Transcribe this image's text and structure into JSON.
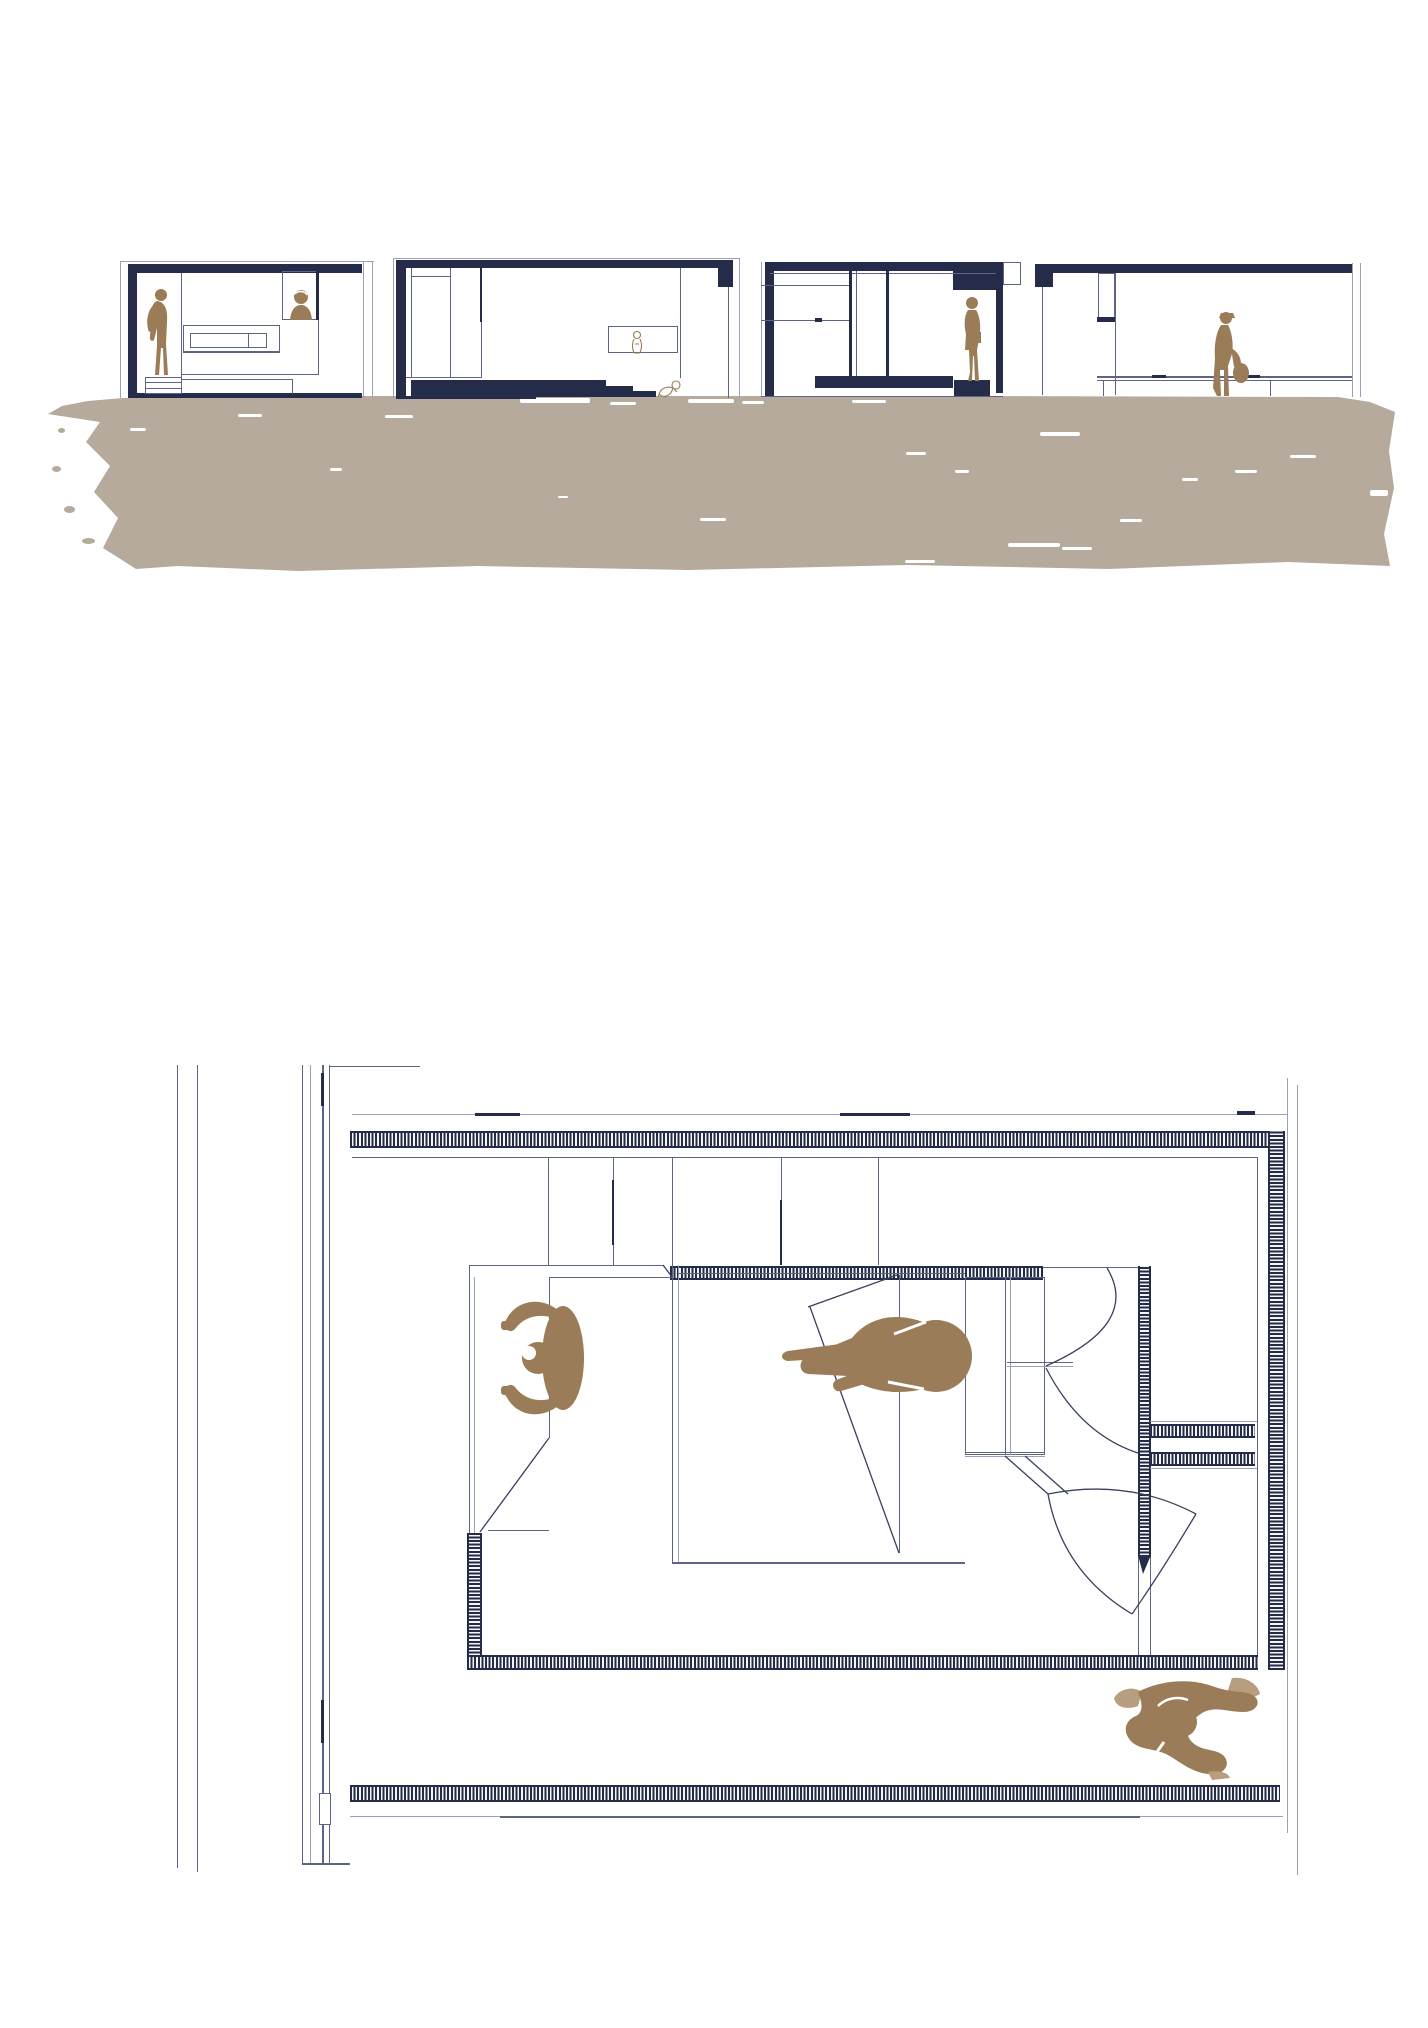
{
  "document": {
    "kind": "architectural drawing sheet",
    "text_content": "none (drawing only, no visible text)",
    "views": [
      {
        "id": "elevations-strip",
        "label": "four sectional elevations standing on a painted sand ground band",
        "sections": [
          {
            "name": "section-1",
            "features": [
              "dark roof slab",
              "dark left wall",
              "standing man figure",
              "high window with woman figure",
              "wall cabinet",
              "drawer plinth"
            ]
          },
          {
            "name": "section-2",
            "features": [
              "dark roof slab with dropped right end",
              "dark left wall",
              "tall wardrobe lines",
              "dark bed platform with steps",
              "wall niche with sketched figure",
              "crawling infant sketch"
            ]
          },
          {
            "name": "section-3",
            "features": [
              "dark roof slab",
              "dark left and right walls",
              "sliding glass door mullions",
              "standing woman on dark plinth",
              "dark floor slab"
            ]
          },
          {
            "name": "section-4",
            "features": [
              "dark roof slab with dropped left end",
              "tall window frame",
              "long low bench line",
              "walking woman with handbag"
            ]
          }
        ],
        "ground": {
          "style": "rough hand-painted band",
          "color_key": "sand",
          "speckles": "small white paint gaps"
        }
      },
      {
        "id": "floor-plan",
        "label": "bedroom floor plan with hatched walls",
        "features": [
          "double guide wall at far left",
          "mullion wall column",
          "hatched top wall",
          "hatched right wall",
          "inner bedroom with hatched enclosure",
          "double bed with folded throw",
          "daybed corner with folded blanket",
          "wardrobe with bi-fold door arcs",
          "door-leaf petals",
          "two wall stubs to right wall",
          "terrace strip below room"
        ],
        "figures": [
          "person stretching with arms arched overhead",
          "person sitting cross-legged on bed",
          "person walking on terrace (two-tone coat)"
        ]
      }
    ],
    "figure_count": 9
  },
  "palette": {
    "navy": "#242c49",
    "line": "#5c6585",
    "line_light": "#9aa1b8",
    "stroke": "#39405e",
    "sand": "#b5aa9b",
    "figure_brown": "#9a7c58",
    "figure_brown_light": "#b89e80",
    "paper": "#ffffff"
  }
}
